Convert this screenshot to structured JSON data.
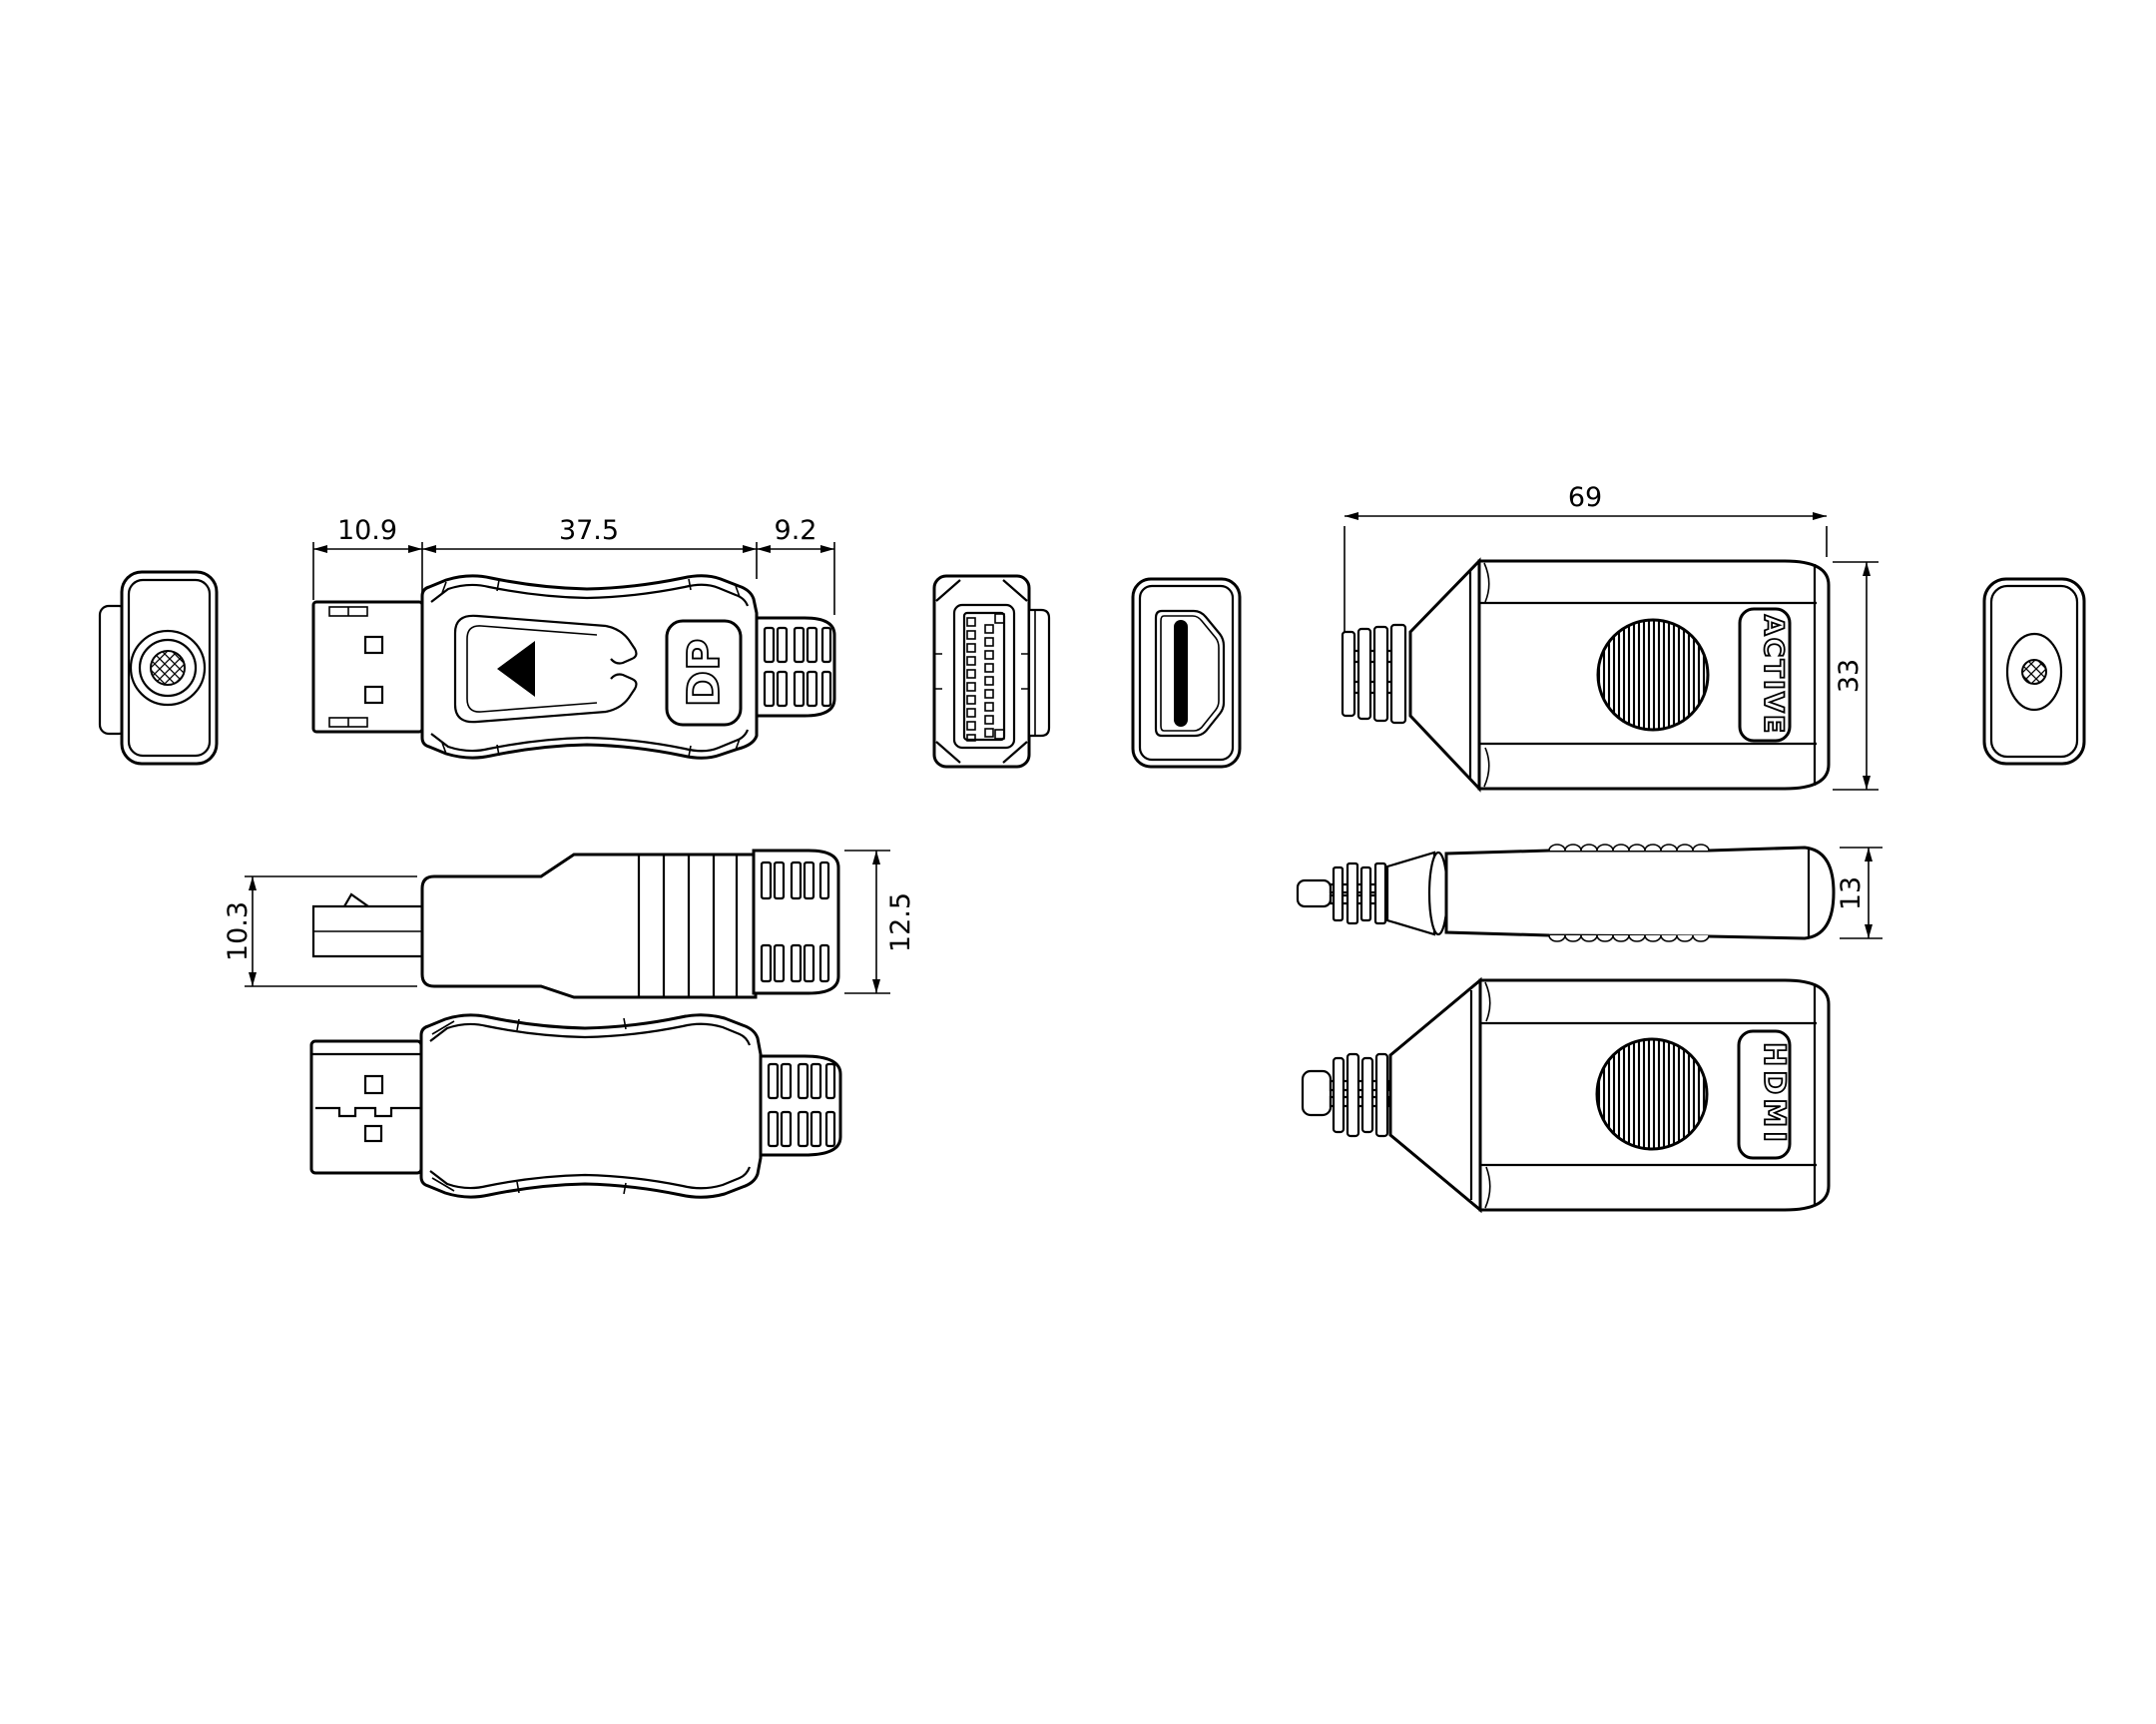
{
  "drawing": {
    "type": "technical-drawing",
    "subject": "displayport-to-hdmi-adapter-and-extender",
    "background_color": "#ffffff",
    "line_color": "#000000",
    "dimensions": {
      "plug_length": "10.9",
      "body_length": "37.5",
      "boot_length": "9.2",
      "plug_height": "10.3",
      "boot_height": "12.5",
      "extender_length": "69",
      "extender_height": "33",
      "extender_thickness": "13"
    },
    "labels": {
      "dp_logo": "DP",
      "active": "ACTIVE",
      "hdmi": "HDMI"
    }
  }
}
